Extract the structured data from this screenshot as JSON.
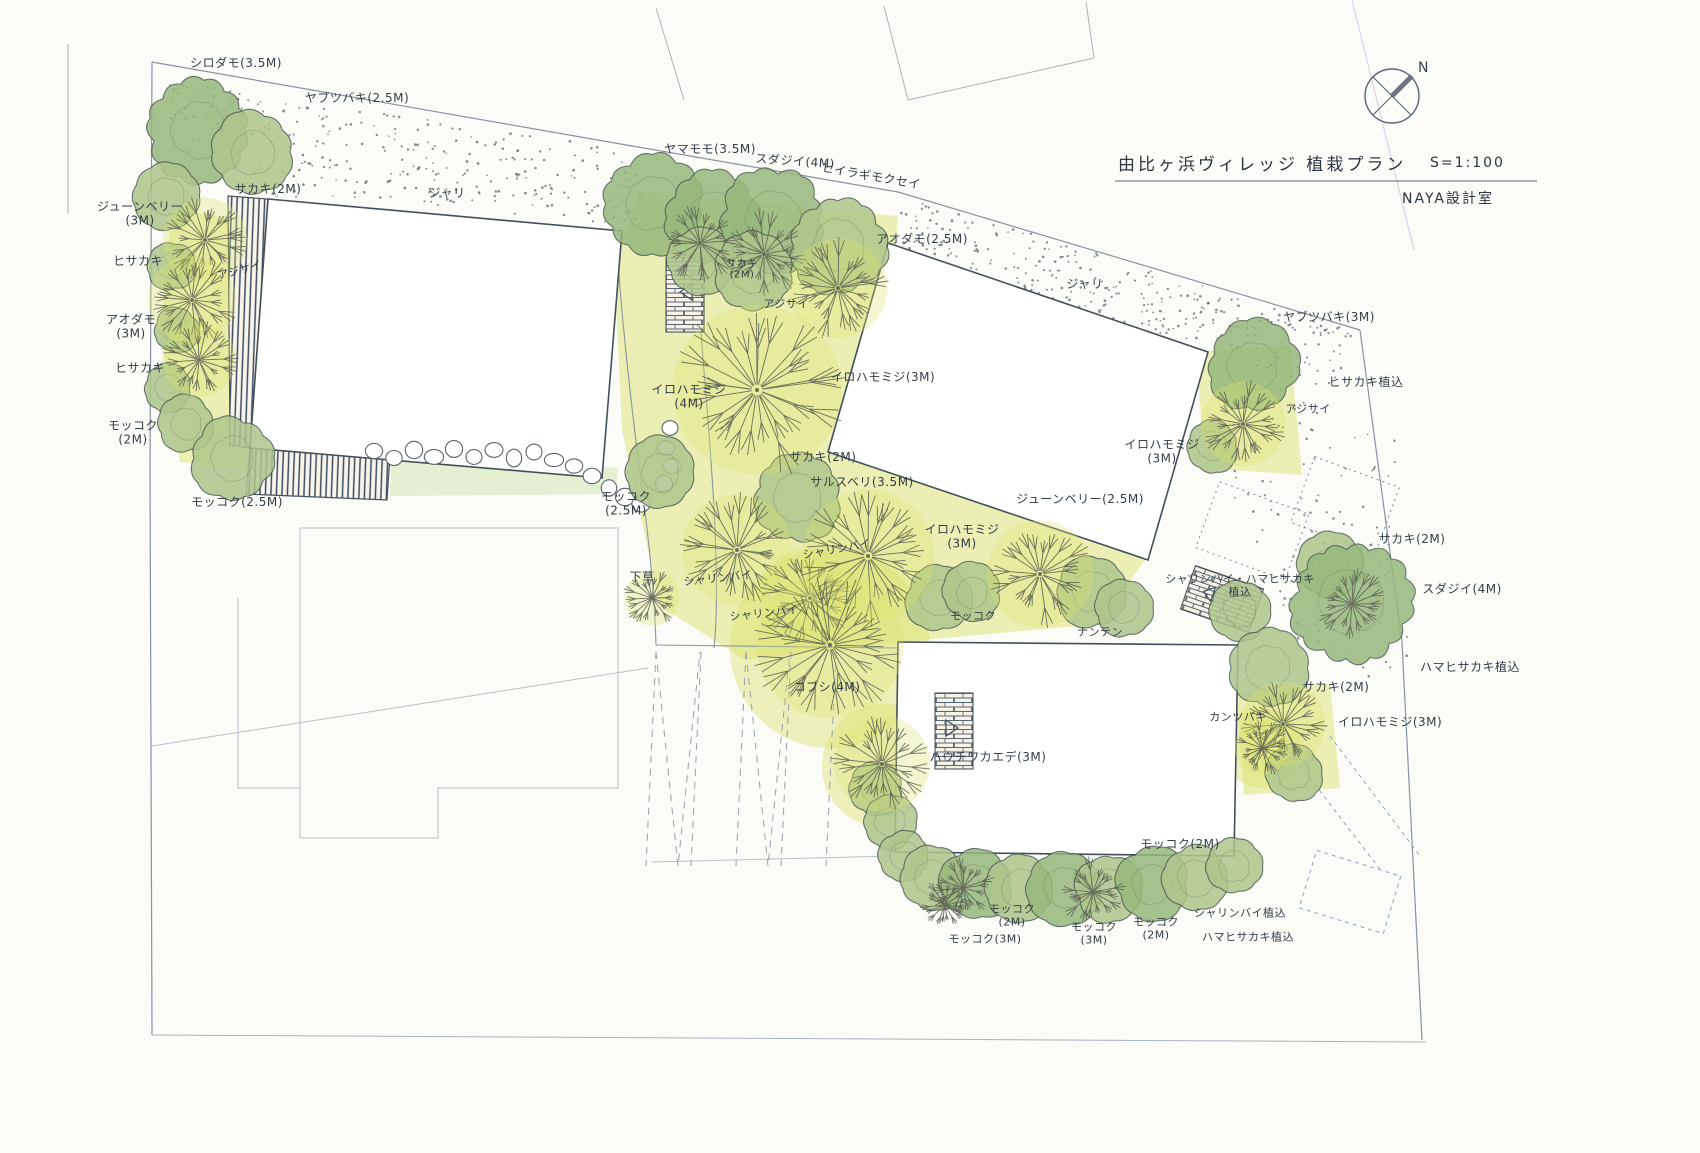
{
  "meta": {
    "title": "由比ヶ浜ヴィレッジ 植栽プラン",
    "scale_label": "S=1:100",
    "office": "NAYA設計室",
    "north_label": "N"
  },
  "colors": {
    "paper": "#fbfbf7",
    "ink": "#333e47",
    "evergreen_tones": [
      "#cdd9a6",
      "#aec68c",
      "#96b87c"
    ],
    "tree_outline": "#4e5c54",
    "branch": "#5c6152",
    "ground_wash": "#dce36f",
    "ground_wash_light": "#cde0a2",
    "stipple": "#49545f",
    "deck_line": "#3f4c5e",
    "boundary": "#8a939e",
    "faint": "#b9c0c8",
    "blue_dash": "#8fa3c0",
    "crease": "#b9aed6"
  },
  "labels": [
    {
      "t": "シロダモ(3.5M)",
      "x": 236,
      "y": 64
    },
    {
      "t": "ヤブツバキ(2.5M)",
      "x": 357,
      "y": 99
    },
    {
      "t": "サカキ(2M)",
      "x": 268,
      "y": 190
    },
    {
      "t": "ジューンベリー\n(3M)",
      "x": 140,
      "y": 214
    },
    {
      "t": "ヒサカキ",
      "x": 138,
      "y": 262
    },
    {
      "t": "アジサイ",
      "x": 240,
      "y": 271,
      "s": 11,
      "r": -15
    },
    {
      "t": "アオダモ\n(3M)",
      "x": 131,
      "y": 327
    },
    {
      "t": "ヒサカキ",
      "x": 140,
      "y": 369
    },
    {
      "t": "モッコク\n(2M)",
      "x": 133,
      "y": 433
    },
    {
      "t": "モッコク(2.5M)",
      "x": 237,
      "y": 503
    },
    {
      "t": "ジャリ",
      "x": 447,
      "y": 194
    },
    {
      "t": "ヤマモモ(3.5M)",
      "x": 710,
      "y": 150
    },
    {
      "t": "スダジイ(4M)",
      "x": 795,
      "y": 162,
      "r": 4
    },
    {
      "t": "ヒイラギモクセイ",
      "x": 871,
      "y": 177,
      "r": 10
    },
    {
      "t": "アオダモ(2.5M)",
      "x": 922,
      "y": 240
    },
    {
      "t": "サカキ\n(2M)",
      "x": 742,
      "y": 270,
      "s": 10
    },
    {
      "t": "アジサイ",
      "x": 786,
      "y": 305,
      "s": 11
    },
    {
      "t": "イロハモミジ(3M)",
      "x": 883,
      "y": 378
    },
    {
      "t": "イロハモミジ\n(4M)",
      "x": 689,
      "y": 397
    },
    {
      "t": "サカキ(2M)",
      "x": 823,
      "y": 458
    },
    {
      "t": "サルスベリ(3.5M)",
      "x": 862,
      "y": 483
    },
    {
      "t": "モッコク\n(2.5M)",
      "x": 626,
      "y": 504
    },
    {
      "t": "ジャリ",
      "x": 1085,
      "y": 285
    },
    {
      "t": "ジューンベリー(2.5M)",
      "x": 1080,
      "y": 500
    },
    {
      "t": "イロハモミジ\n(3M)",
      "x": 962,
      "y": 537
    },
    {
      "t": "シャリンバイ",
      "x": 837,
      "y": 550,
      "s": 11,
      "r": -10
    },
    {
      "t": "シャリンバイ",
      "x": 718,
      "y": 579,
      "s": 11,
      "r": -6
    },
    {
      "t": "シャリンバイ",
      "x": 764,
      "y": 614,
      "s": 11,
      "r": -6
    },
    {
      "t": "下草",
      "x": 642,
      "y": 578
    },
    {
      "t": "モッコク",
      "x": 973,
      "y": 617,
      "s": 11
    },
    {
      "t": "ナンテン",
      "x": 1100,
      "y": 633,
      "s": 11
    },
    {
      "t": "ヤブツバキ(3M)",
      "x": 1329,
      "y": 318
    },
    {
      "t": "ヒサカキ植込",
      "x": 1366,
      "y": 383
    },
    {
      "t": "アジサイ",
      "x": 1308,
      "y": 410,
      "s": 11
    },
    {
      "t": "イロハモミジ\n(3M)",
      "x": 1162,
      "y": 452
    },
    {
      "t": "シャリンバイ・ハマヒサカキ\n植込",
      "x": 1240,
      "y": 586,
      "s": 11
    },
    {
      "t": "サカキ(2M)",
      "x": 1412,
      "y": 540
    },
    {
      "t": "スダジイ(4M)",
      "x": 1462,
      "y": 590
    },
    {
      "t": "ハマヒサカキ植込",
      "x": 1470,
      "y": 668
    },
    {
      "t": "サカキ(2M)",
      "x": 1336,
      "y": 688
    },
    {
      "t": "カンツバキ",
      "x": 1238,
      "y": 718,
      "s": 11
    },
    {
      "t": "イロハモミジ(3M)",
      "x": 1390,
      "y": 723
    },
    {
      "t": "コブシ(4M)",
      "x": 827,
      "y": 688
    },
    {
      "t": "ハウチワカエデ(3M)",
      "x": 988,
      "y": 758
    },
    {
      "t": "モッコク(2M)",
      "x": 1180,
      "y": 845
    },
    {
      "t": "モッコク\n(2M)",
      "x": 1012,
      "y": 916,
      "s": 11
    },
    {
      "t": "モッコク(3M)",
      "x": 985,
      "y": 940,
      "s": 11
    },
    {
      "t": "モッコク\n(3M)",
      "x": 1094,
      "y": 934,
      "s": 11
    },
    {
      "t": "モッコク\n(2M)",
      "x": 1156,
      "y": 929,
      "s": 11
    },
    {
      "t": "シャリンバイ植込",
      "x": 1240,
      "y": 914,
      "s": 11
    },
    {
      "t": "ハマヒサカキ植込",
      "x": 1248,
      "y": 938,
      "s": 11
    }
  ],
  "plan": {
    "evergreen_trees": [
      [
        198,
        130,
        50,
        2
      ],
      [
        253,
        152,
        40,
        1
      ],
      [
        167,
        196,
        32,
        1
      ],
      [
        171,
        266,
        24,
        1
      ],
      [
        176,
        330,
        22,
        1
      ],
      [
        168,
        388,
        23,
        1
      ],
      [
        186,
        424,
        28,
        1
      ],
      [
        232,
        458,
        40,
        1
      ],
      [
        652,
        204,
        48,
        2
      ],
      [
        712,
        218,
        46,
        2
      ],
      [
        772,
        220,
        50,
        2
      ],
      [
        838,
        246,
        46,
        1
      ],
      [
        700,
        262,
        33,
        1
      ],
      [
        752,
        272,
        38,
        1
      ],
      [
        660,
        472,
        34,
        1
      ],
      [
        797,
        498,
        42,
        1
      ],
      [
        938,
        598,
        32,
        1
      ],
      [
        972,
        592,
        28,
        1
      ],
      [
        1092,
        592,
        36,
        1
      ],
      [
        1124,
        608,
        28,
        1
      ],
      [
        1253,
        366,
        44,
        2
      ],
      [
        1212,
        446,
        26,
        1
      ],
      [
        1240,
        610,
        30,
        1
      ],
      [
        1330,
        566,
        32,
        1
      ],
      [
        1352,
        602,
        58,
        2
      ],
      [
        1268,
        668,
        38,
        1
      ],
      [
        1294,
        774,
        28,
        1
      ],
      [
        876,
        788,
        26,
        1
      ],
      [
        890,
        822,
        27,
        1
      ],
      [
        904,
        856,
        25,
        1
      ],
      [
        932,
        878,
        32,
        1
      ],
      [
        976,
        884,
        36,
        2
      ],
      [
        1020,
        888,
        33,
        1
      ],
      [
        1064,
        888,
        36,
        2
      ],
      [
        1108,
        888,
        33,
        1
      ],
      [
        1152,
        884,
        36,
        2
      ],
      [
        1196,
        878,
        32,
        1
      ],
      [
        1234,
        866,
        28,
        1
      ]
    ],
    "deciduous_trees": [
      [
        205,
        240,
        46,
        1
      ],
      [
        192,
        300,
        48,
        1
      ],
      [
        199,
        360,
        40,
        1
      ],
      [
        700,
        243,
        42,
        0
      ],
      [
        764,
        254,
        46,
        0
      ],
      [
        838,
        288,
        54,
        1
      ],
      [
        757,
        390,
        92,
        1
      ],
      [
        737,
        550,
        60,
        1
      ],
      [
        810,
        598,
        55,
        1
      ],
      [
        868,
        556,
        72,
        1
      ],
      [
        1040,
        574,
        58,
        1
      ],
      [
        652,
        598,
        30,
        1
      ],
      [
        1243,
        424,
        46,
        1
      ],
      [
        1352,
        604,
        40,
        0
      ],
      [
        1283,
        724,
        46,
        1
      ],
      [
        1262,
        748,
        30,
        1
      ],
      [
        830,
        645,
        80,
        1
      ],
      [
        882,
        764,
        52,
        1
      ],
      [
        963,
        888,
        34,
        0
      ],
      [
        1093,
        892,
        36,
        0
      ],
      [
        945,
        905,
        28,
        0
      ]
    ],
    "ground_polys": [
      {
        "c": 0,
        "pts": [
          [
            172,
            210
          ],
          [
            248,
            220
          ],
          [
            262,
            330
          ],
          [
            250,
            470
          ],
          [
            180,
            462
          ],
          [
            160,
            330
          ]
        ]
      },
      {
        "c": 0,
        "pts": [
          [
            640,
            192
          ],
          [
            898,
            216
          ],
          [
            880,
            452
          ],
          [
            1146,
            558
          ],
          [
            1100,
            624
          ],
          [
            900,
            642
          ],
          [
            745,
            660
          ],
          [
            660,
            606
          ],
          [
            622,
            430
          ],
          [
            614,
            262
          ]
        ]
      },
      {
        "c": 0,
        "pts": [
          [
            1196,
            352
          ],
          [
            1290,
            345
          ],
          [
            1302,
            475
          ],
          [
            1205,
            468
          ]
        ]
      },
      {
        "c": 0,
        "pts": [
          [
            1236,
            692
          ],
          [
            1330,
            684
          ],
          [
            1340,
            788
          ],
          [
            1244,
            795
          ]
        ]
      },
      {
        "c": 1,
        "pts": [
          [
            392,
            450
          ],
          [
            618,
            468
          ],
          [
            616,
            494
          ],
          [
            390,
            496
          ]
        ]
      }
    ],
    "ground_circles": [
      [
        830,
        648,
        100
      ],
      [
        884,
        766,
        62
      ],
      [
        1262,
        748,
        40
      ]
    ],
    "stepping_stones": [
      [
        374,
        451
      ],
      [
        394,
        458
      ],
      [
        414,
        450
      ],
      [
        434,
        457
      ],
      [
        454,
        449
      ],
      [
        474,
        457
      ],
      [
        494,
        450
      ],
      [
        514,
        458
      ],
      [
        534,
        452
      ],
      [
        554,
        460
      ],
      [
        574,
        466
      ],
      [
        592,
        476
      ],
      [
        609,
        488
      ],
      [
        625,
        497
      ],
      [
        641,
        504
      ],
      [
        670,
        428
      ],
      [
        666,
        448
      ],
      [
        672,
        466
      ],
      [
        664,
        484
      ]
    ]
  }
}
